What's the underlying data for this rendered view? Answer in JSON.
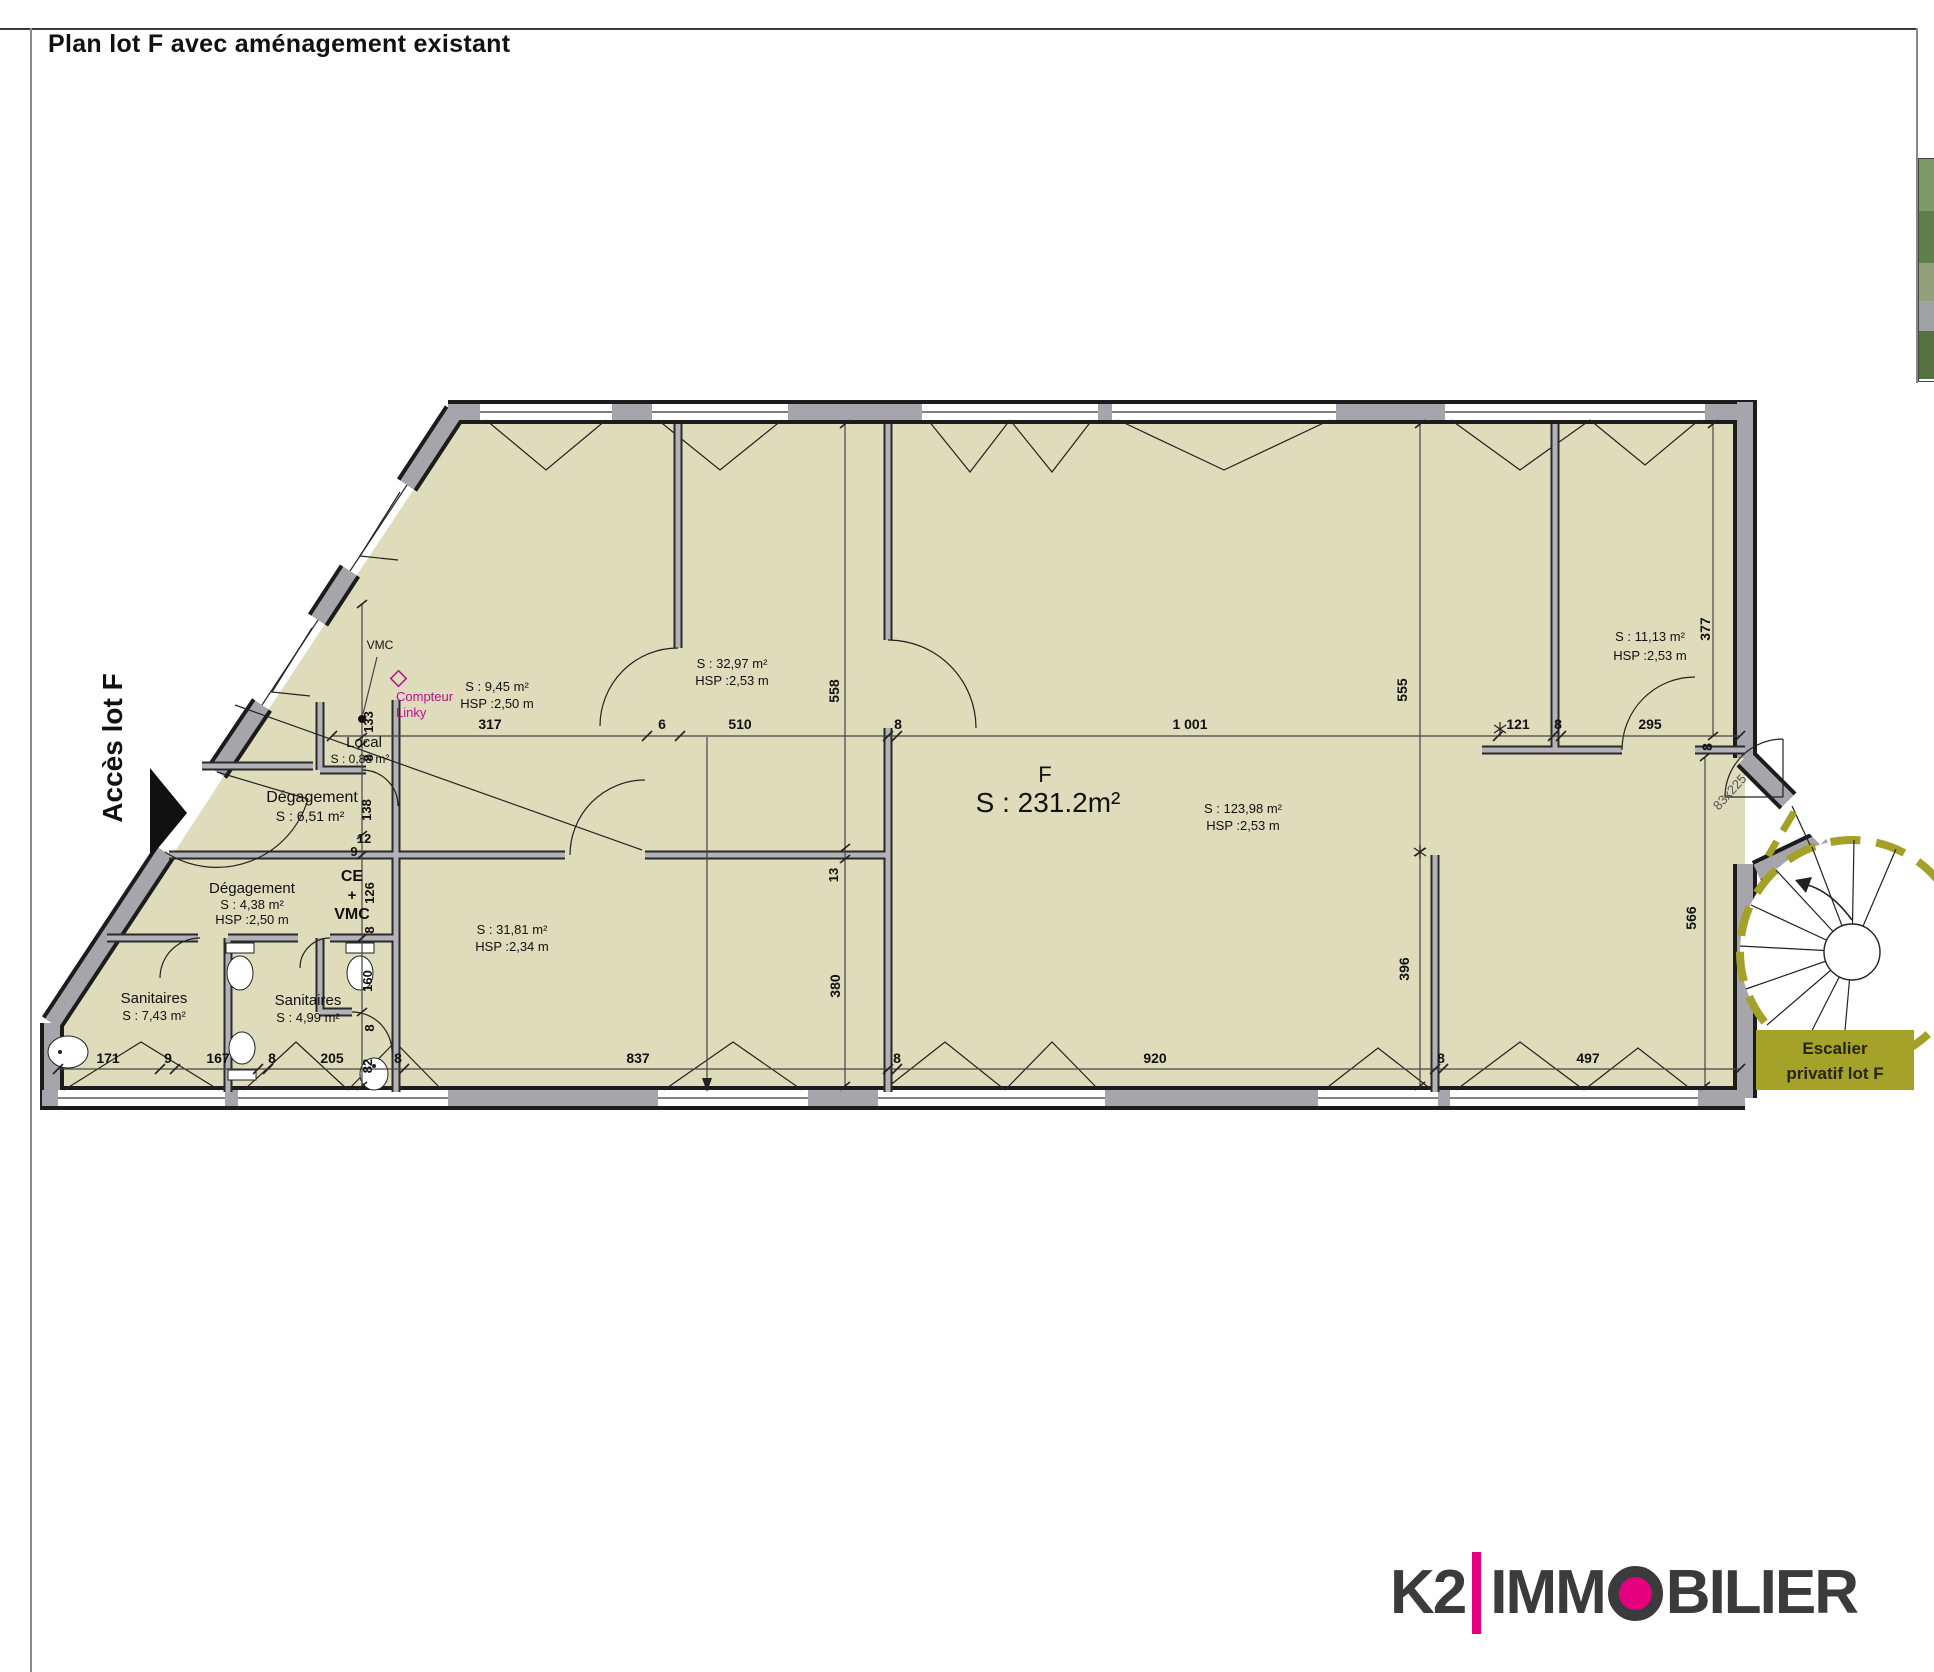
{
  "page": {
    "title": "Plan lot F avec aménagement existant"
  },
  "branding": {
    "k2": "K2",
    "immo_pre": "IMM",
    "immo_post": "BILIER",
    "accent": "#e5007d",
    "dark": "#3b3b3d"
  },
  "plan": {
    "stair_box": {
      "line1": "Escalier",
      "line2": "privatif lot F"
    },
    "colors": {
      "floor": "#dedcba",
      "wall": "#a6a5ab",
      "stair_dash": "#a4a128",
      "magenta": "#b5128f",
      "stair_box_bg": "#a5a22a"
    },
    "labels": [
      {
        "n": "access-label",
        "t": "Accès lot F",
        "x": 122,
        "y": 748,
        "s": 28,
        "b": 1,
        "rot": -90
      },
      {
        "n": "room-local-name",
        "t": "Local",
        "x": 364,
        "y": 747,
        "s": 15
      },
      {
        "n": "room-local-area",
        "t": "S : 0,88 m²",
        "x": 360,
        "y": 763,
        "s": 12
      },
      {
        "n": "room-degagement1-name",
        "t": "Dégagement",
        "x": 312,
        "y": 802,
        "s": 16
      },
      {
        "n": "room-degagement1-area",
        "t": "S : 6,51 m²",
        "x": 310,
        "y": 821,
        "s": 14
      },
      {
        "n": "room-degagement2-name",
        "t": "Dégagement",
        "x": 252,
        "y": 893,
        "s": 15
      },
      {
        "n": "room-degagement2-area",
        "t": "S : 4,38 m²",
        "x": 252,
        "y": 909,
        "s": 13
      },
      {
        "n": "room-degagement2-hsp",
        "t": "HSP :2,50 m",
        "x": 252,
        "y": 924,
        "s": 13
      },
      {
        "n": "room-sanitaires1-name",
        "t": "Sanitaires",
        "x": 154,
        "y": 1003,
        "s": 15
      },
      {
        "n": "room-sanitaires1-area",
        "t": "S : 7,43 m²",
        "x": 154,
        "y": 1020,
        "s": 13
      },
      {
        "n": "room-sanitaires2-name",
        "t": "Sanitaires",
        "x": 308,
        "y": 1005,
        "s": 15
      },
      {
        "n": "room-sanitaires2-area",
        "t": "S : 4,99 m²",
        "x": 308,
        "y": 1022,
        "s": 13
      },
      {
        "n": "room-ce-label",
        "t": "CE",
        "x": 352,
        "y": 881,
        "s": 16,
        "b": 1
      },
      {
        "n": "room-ce-plus",
        "t": "+",
        "x": 352,
        "y": 900,
        "s": 15,
        "b": 1
      },
      {
        "n": "room-vmc-label",
        "t": "VMC",
        "x": 352,
        "y": 919,
        "s": 16,
        "b": 1
      },
      {
        "n": "room-945-area",
        "t": "S : 9,45 m²",
        "x": 497,
        "y": 691,
        "s": 13
      },
      {
        "n": "room-945-hsp",
        "t": "HSP :2,50 m",
        "x": 497,
        "y": 708,
        "s": 13
      },
      {
        "n": "room-3297-area",
        "t": "S : 32,97 m²",
        "x": 732,
        "y": 668,
        "s": 13
      },
      {
        "n": "room-3297-hsp",
        "t": "HSP :2,53 m",
        "x": 732,
        "y": 685,
        "s": 13
      },
      {
        "n": "room-3181-area",
        "t": "S : 31,81 m²",
        "x": 512,
        "y": 934,
        "s": 13
      },
      {
        "n": "room-3181-hsp",
        "t": "HSP :2,34 m",
        "x": 512,
        "y": 951,
        "s": 13
      },
      {
        "n": "lot-letter",
        "t": "F",
        "x": 1045,
        "y": 782,
        "s": 22
      },
      {
        "n": "lot-area",
        "t": "S : 231.2m²",
        "x": 1048,
        "y": 812,
        "s": 28
      },
      {
        "n": "room-12398-area",
        "t": "S : 123,98 m²",
        "x": 1243,
        "y": 813,
        "s": 13
      },
      {
        "n": "room-12398-hsp",
        "t": "HSP :2,53 m",
        "x": 1243,
        "y": 830,
        "s": 13
      },
      {
        "n": "room-1113-area",
        "t": "S : 11,13 m²",
        "x": 1650,
        "y": 641,
        "s": 13
      },
      {
        "n": "room-1113-hsp",
        "t": "HSP :2,53 m",
        "x": 1650,
        "y": 660,
        "s": 13
      },
      {
        "n": "vmc-duct-label",
        "t": "VMC",
        "x": 380,
        "y": 649,
        "s": 12
      },
      {
        "n": "compteur-linky-1",
        "t": "Compteur",
        "x": 396,
        "y": 701,
        "s": 13,
        "c": "#b5128f",
        "a": "start"
      },
      {
        "n": "compteur-linky-2",
        "t": "Linky",
        "x": 396,
        "y": 717,
        "s": 13,
        "c": "#b5128f",
        "a": "start"
      },
      {
        "n": "stair-door-size",
        "t": "83x225",
        "x": 1733,
        "y": 795,
        "s": 13,
        "rot": -48,
        "c": "#555"
      },
      {
        "n": "dim-317",
        "t": "317",
        "x": 490,
        "y": 729,
        "s": 14,
        "b": 1
      },
      {
        "n": "dim-6",
        "t": "6",
        "x": 662,
        "y": 729,
        "s": 14,
        "b": 1
      },
      {
        "n": "dim-510",
        "t": "510",
        "x": 740,
        "y": 729,
        "s": 14,
        "b": 1
      },
      {
        "n": "dim-8a",
        "t": "8",
        "x": 898,
        "y": 729,
        "s": 14,
        "b": 1
      },
      {
        "n": "dim-1001",
        "t": "1 001",
        "x": 1190,
        "y": 729,
        "s": 14,
        "b": 1
      },
      {
        "n": "dim-121",
        "t": "121",
        "x": 1518,
        "y": 729,
        "s": 14,
        "b": 1
      },
      {
        "n": "dim-8b",
        "t": "8",
        "x": 1558,
        "y": 729,
        "s": 14,
        "b": 1
      },
      {
        "n": "dim-295",
        "t": "295",
        "x": 1650,
        "y": 729,
        "s": 14,
        "b": 1
      },
      {
        "n": "dim-8c",
        "t": "8",
        "x": 1712,
        "y": 747,
        "s": 14,
        "b": 1,
        "rot": -90
      },
      {
        "n": "dim-171",
        "t": "171",
        "x": 108,
        "y": 1063,
        "s": 14,
        "b": 1
      },
      {
        "n": "dim-9a",
        "t": "9",
        "x": 168,
        "y": 1063,
        "s": 14,
        "b": 1
      },
      {
        "n": "dim-167",
        "t": "167",
        "x": 218,
        "y": 1063,
        "s": 14,
        "b": 1
      },
      {
        "n": "dim-8d",
        "t": "8",
        "x": 272,
        "y": 1063,
        "s": 14,
        "b": 1
      },
      {
        "n": "dim-205",
        "t": "205",
        "x": 332,
        "y": 1063,
        "s": 14,
        "b": 1
      },
      {
        "n": "dim-82",
        "t": "82",
        "x": 372,
        "y": 1066,
        "s": 13,
        "b": 1,
        "rot": -90
      },
      {
        "n": "dim-8e",
        "t": "8",
        "x": 398,
        "y": 1063,
        "s": 14,
        "b": 1
      },
      {
        "n": "dim-837",
        "t": "837",
        "x": 638,
        "y": 1063,
        "s": 14,
        "b": 1
      },
      {
        "n": "dim-8f",
        "t": "8",
        "x": 897,
        "y": 1063,
        "s": 14,
        "b": 1
      },
      {
        "n": "dim-920",
        "t": "920",
        "x": 1155,
        "y": 1063,
        "s": 14,
        "b": 1
      },
      {
        "n": "dim-8g",
        "t": "8",
        "x": 1441,
        "y": 1063,
        "s": 14,
        "b": 1
      },
      {
        "n": "dim-497",
        "t": "497",
        "x": 1588,
        "y": 1063,
        "s": 14,
        "b": 1
      },
      {
        "n": "dim-133",
        "t": "133",
        "x": 373,
        "y": 722,
        "s": 13,
        "b": 1,
        "rot": -90
      },
      {
        "n": "dim-8h",
        "t": "8",
        "x": 373,
        "y": 758,
        "s": 13,
        "b": 1,
        "rot": -90
      },
      {
        "n": "dim-138",
        "t": "138",
        "x": 371,
        "y": 810,
        "s": 13,
        "b": 1,
        "rot": -90
      },
      {
        "n": "dim-12",
        "t": "12",
        "x": 364,
        "y": 843,
        "s": 13,
        "b": 1
      },
      {
        "n": "dim-9b",
        "t": "9",
        "x": 354,
        "y": 856,
        "s": 13,
        "b": 1
      },
      {
        "n": "dim-126",
        "t": "126",
        "x": 374,
        "y": 893,
        "s": 13,
        "b": 1,
        "rot": -90
      },
      {
        "n": "dim-8i",
        "t": "8",
        "x": 374,
        "y": 930,
        "s": 13,
        "b": 1,
        "rot": -90
      },
      {
        "n": "dim-160",
        "t": "160",
        "x": 372,
        "y": 981,
        "s": 13,
        "b": 1,
        "rot": -90
      },
      {
        "n": "dim-8j",
        "t": "8",
        "x": 374,
        "y": 1028,
        "s": 13,
        "b": 1,
        "rot": -90
      },
      {
        "n": "dim-558",
        "t": "558",
        "x": 839,
        "y": 691,
        "s": 14,
        "b": 1,
        "rot": -90
      },
      {
        "n": "dim-13",
        "t": "13",
        "x": 838,
        "y": 875,
        "s": 13,
        "b": 1,
        "rot": -90
      },
      {
        "n": "dim-380",
        "t": "380",
        "x": 840,
        "y": 986,
        "s": 14,
        "b": 1,
        "rot": -90
      },
      {
        "n": "dim-555",
        "t": "555",
        "x": 1407,
        "y": 690,
        "s": 14,
        "b": 1,
        "rot": -90
      },
      {
        "n": "dim-396",
        "t": "396",
        "x": 1409,
        "y": 969,
        "s": 14,
        "b": 1,
        "rot": -90
      },
      {
        "n": "dim-377",
        "t": "377",
        "x": 1710,
        "y": 629,
        "s": 14,
        "b": 1,
        "rot": -90
      },
      {
        "n": "dim-566",
        "t": "566",
        "x": 1696,
        "y": 918,
        "s": 14,
        "b": 1,
        "rot": -90
      }
    ]
  }
}
